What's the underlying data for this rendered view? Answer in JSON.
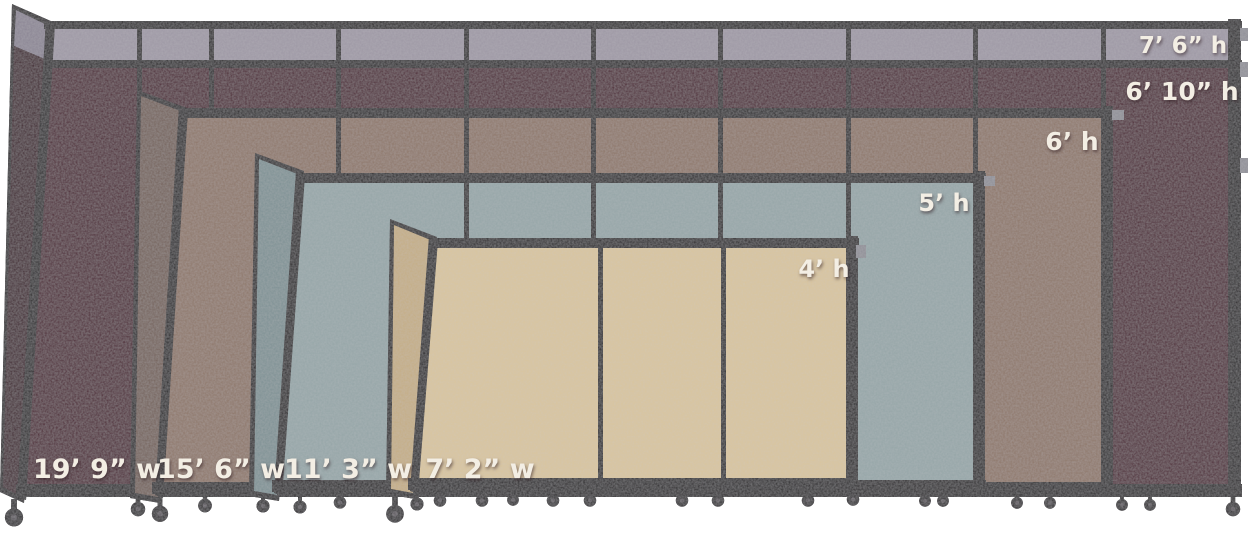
{
  "background": "#ffffff",
  "frame_color": "#221f21",
  "label_color": "#f3eee4",
  "bracket_color": "#8e8e96",
  "dividers": [
    {
      "id": "cranberry",
      "fabric": "#4b2130",
      "fabric_shaded": "#3b1a26",
      "top_panel": "#9d97a4",
      "top_panel_shaded": "#8a8493",
      "extended_height_label": "7’ 6” h",
      "height_label": "6’ 10” h",
      "width_label": "19’ 9” w"
    },
    {
      "id": "mocha",
      "fabric": "#8d7567",
      "fabric_shaded": "#736058",
      "height_label": "6’ h",
      "width_label": "15’ 6” w"
    },
    {
      "id": "ocean",
      "fabric": "#94a5a7",
      "fabric_shaded": "#7d9093",
      "height_label": "5’ h",
      "width_label": "11’ 3” w"
    },
    {
      "id": "sand",
      "fabric": "#d9c59d",
      "fabric_shaded": "#c5ad84",
      "height_label": "4’ h",
      "width_label": "7’ 2” w"
    }
  ]
}
